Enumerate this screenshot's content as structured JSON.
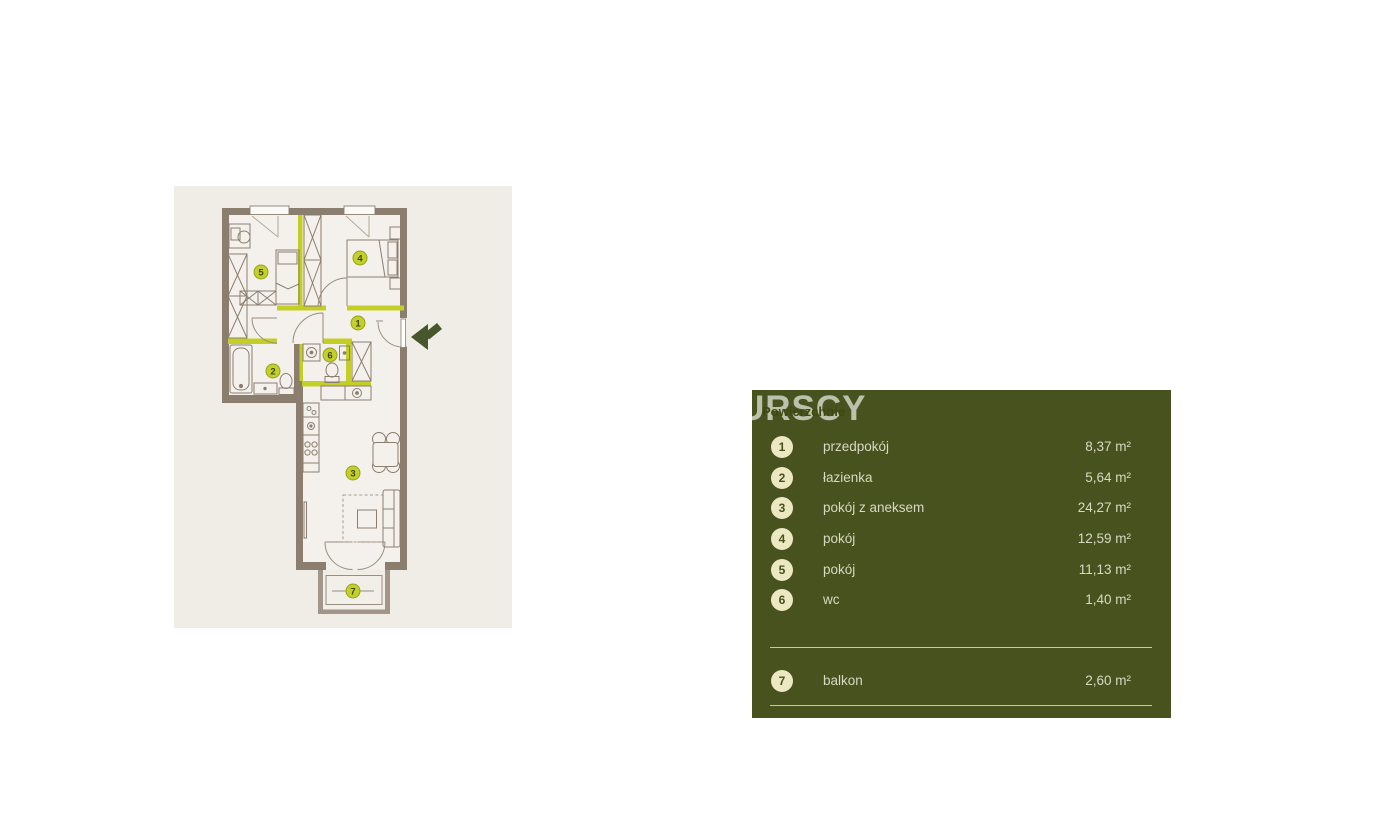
{
  "legend": {
    "watermark": "URSCY",
    "title": "Powierzchnie",
    "rooms": [
      {
        "number": "1",
        "name": "przedpokój",
        "area": "8,37 m²"
      },
      {
        "number": "2",
        "name": "łazienka",
        "area": "5,64 m²"
      },
      {
        "number": "3",
        "name": "pokój z aneksem",
        "area": "24,27 m²"
      },
      {
        "number": "4",
        "name": "pokój",
        "area": "12,59 m²"
      },
      {
        "number": "5",
        "name": "pokój",
        "area": "11,13 m²"
      },
      {
        "number": "6",
        "name": "wc",
        "area": "1,40 m²"
      }
    ],
    "extra": [
      {
        "number": "7",
        "name": "balkon",
        "area": "2,60 m²"
      }
    ]
  },
  "colors": {
    "panel_bg": "#47521e",
    "badge_cream": "#ece9c2",
    "plan_bg": "#f0ede6",
    "wall_brown": "#8b7e6f",
    "accent_lime": "#c3ce26",
    "plan_badge_lime": "#c4cf2b",
    "arrow_green": "#48562b"
  }
}
